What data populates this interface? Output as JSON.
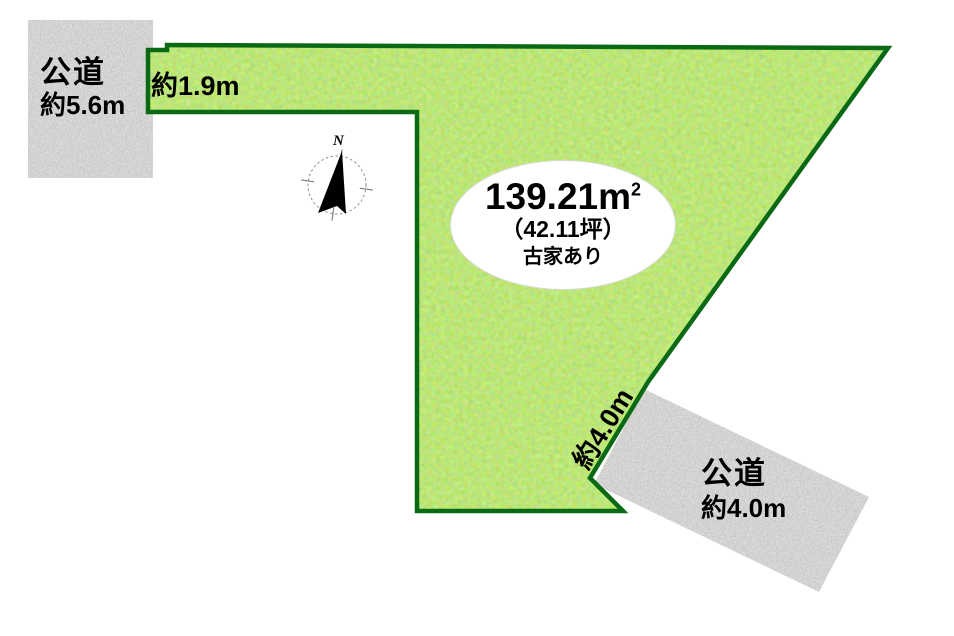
{
  "diagram": {
    "type": "land-plot-map",
    "background": "#ffffff"
  },
  "parcel": {
    "area_value": "139.21m",
    "area_sup": "2",
    "area_tsubo": "（42.11坪）",
    "note": "古家あり",
    "frontage_north": "約1.9m",
    "frontage_southeast": "約4.0m",
    "fill_color": "#81D130",
    "border_color": "#0A6914"
  },
  "roads": {
    "west": {
      "name": "公道",
      "width": "約5.6m"
    },
    "southeast": {
      "name": "公道",
      "width": "約4.0m"
    },
    "surface_color": "#A8A6A3"
  },
  "compass": {
    "north": "N"
  }
}
